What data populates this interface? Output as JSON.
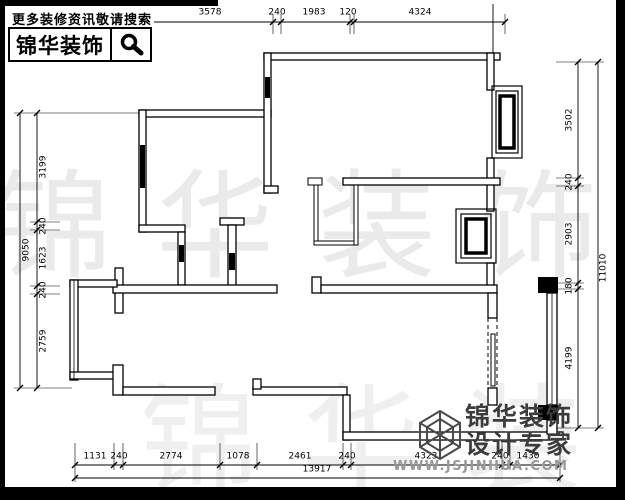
{
  "header": {
    "tagline": "更多装修资讯敬请搜索",
    "brand": "锦华装饰",
    "search_icon": "magnifier-icon"
  },
  "watermark": {
    "text": "锦华装饰"
  },
  "footer_logo": {
    "brand": "锦华装饰",
    "subtitle": "设计专家",
    "website": "WWW.JSJINHUA.COM",
    "mark": "hex-cube-logo"
  },
  "dimensions": {
    "top": {
      "segments": [
        "1248",
        "644",
        "240",
        "3578",
        "240",
        "1983",
        "120",
        "4324"
      ]
    },
    "bottom": {
      "segments": [
        "1131",
        "240",
        "2774",
        "1078",
        "2461",
        "240",
        "4323",
        "240",
        "1430"
      ],
      "total": "13917"
    },
    "left": {
      "segments": [
        "3199",
        "240",
        "1623",
        "240",
        "2759"
      ],
      "total": "9050"
    },
    "right": {
      "segments": [
        "3502",
        "240",
        "2903",
        "180",
        "4199"
      ],
      "total": "11010"
    }
  }
}
